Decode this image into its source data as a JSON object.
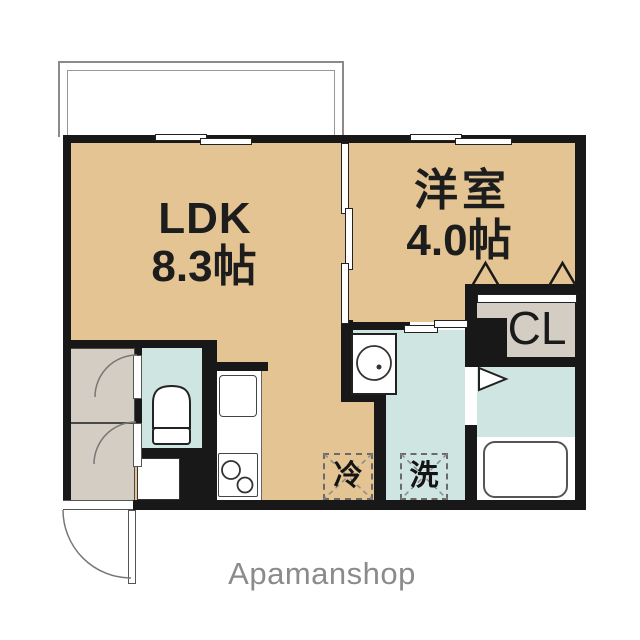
{
  "floorplan": {
    "ldk": {
      "name": "LDK",
      "area": "8.3帖"
    },
    "bedroom": {
      "name": "洋室",
      "area": "4.0帖"
    },
    "closet_label": "CL",
    "fridge_label": "冷",
    "washer_label": "洗",
    "brand": "Apamanshop",
    "colors": {
      "floor_tan": "#e3c492",
      "wet_area_blue": "#cfe5e2",
      "closet_gray": "#d4cdc4",
      "wall_black": "#181818",
      "brand_gray": "#8b8b8b"
    }
  }
}
